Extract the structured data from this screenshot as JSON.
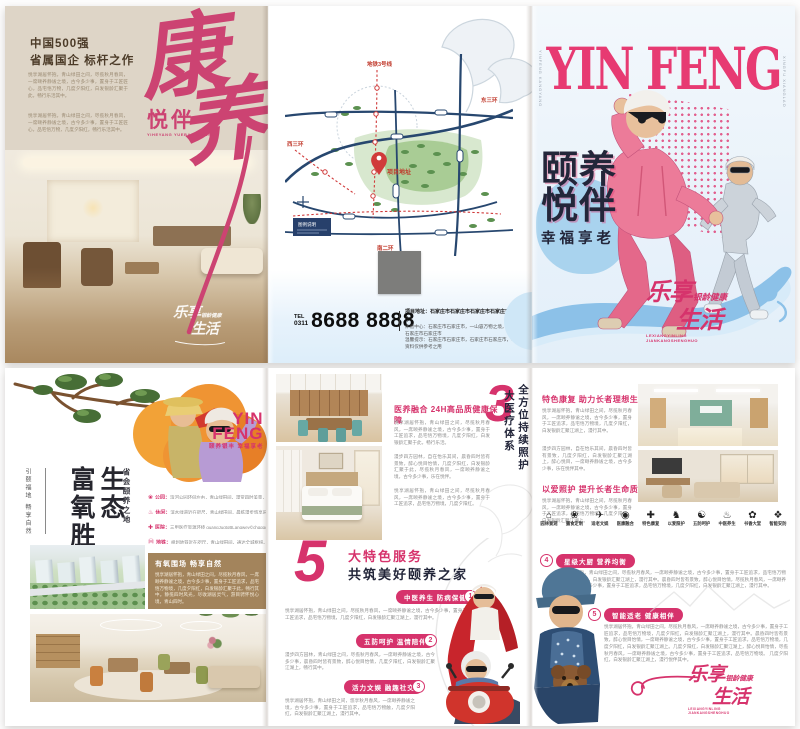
{
  "colors": {
    "magenta": "#d6336c",
    "calligraphy_pink": "#cc4372",
    "navy_title": "#23263a",
    "beige_panel": "#ded5c7",
    "brown_box": "#a3845c",
    "map_blue": "#27476f",
    "map_green": "#5c9150",
    "pale_blue": "#e9f3fb",
    "swoosh_blue": "#8cc1e8"
  },
  "slogan_logo": {
    "big1": "乐享",
    "small": "银龄健康",
    "big2": "生活",
    "pinyin1": "LEXIANGYINLING",
    "pinyin2": "JIANKANGSHENGHUO"
  },
  "outer_left": {
    "headline1": "中国500强",
    "headline2": "省属国企 标杆之作",
    "para1": "悦享湖居怀抱，青山绿田之间，尽揽秋月春风，一席颐养静谧之境，古今多少事，置身于工匠匠心，品宅悟万物，几度夕阳红，白发银龄汇聚于此，畅行乐活其中。",
    "para2": "悦享湖居怀抱，青山绿田之间，尽揽秋月春风，一席颐养静谧之境，古今多少事，置身于工匠匠心，品宅悟万物，几度夕阳红，畅行乐活其中。",
    "calligraphy1": "康",
    "calligraphy2": "养",
    "script_sub": "悦伴",
    "script_pinyin": "YIHEYANG YUEBAN XINGFU"
  },
  "outer_middle": {
    "map_labels": {
      "metro_top": "地铁3号线",
      "east": "东三环",
      "west": "西三环",
      "south": "南二环",
      "project": "项目地址",
      "legend": "图例说明"
    },
    "tel_label": "TEL",
    "tel_area": "0311",
    "tel_number": "8688 8888",
    "address_bold": "项目地址：石家庄市石家庄市石家庄市石家庄市石家庄市",
    "address_small1": "体验中心：石家庄市石家庄市，一山容万物之境，石家庄市石家庄市石家庄市",
    "address_small2": "温馨提示：石家庄市石家庄市，石家庄市石家庄市，本宣传资料仅供参考之用"
  },
  "cover": {
    "masthead": "YIN FENG",
    "side_text": "YINFENG KANGYANG",
    "side_text2": "XINGFU XIANGLAO",
    "title1": "颐养",
    "title2": "悦伴",
    "subtitle": "幸福享老"
  },
  "inner_left": {
    "logo1": "YIN",
    "logo2": "FENG",
    "logo_sub": "颐养银丰 幸福享老",
    "v_title_right": "生态",
    "v_title_left": "富氧胜境",
    "v_sub": "省会颐养之地",
    "v_side": "引颐福地 畅享自然",
    "list": [
      {
        "icon": "❀",
        "label": "公园：",
        "text": "滨河公园环伺左右，青山绿田间，漫赏四时美景，一路畅怀。"
      },
      {
        "icon": "♨",
        "label": "休闲：",
        "text": "滨水绿道近在咫尺，青山绿田间，晨练漫步悠享乐龄。"
      },
      {
        "icon": "✚",
        "label": "医院：",
        "text": "三甲医疗资源环绕 guangJugtoBLangwey©chgqgo。"
      },
      {
        "icon": "Ⓜ",
        "label": "地铁：",
        "text": "规划地铁近在咫尺，青山绿田间，通达全城枢纽。"
      },
      {
        "icon": "⇄",
        "label": "交通：",
        "text": "三横四纵路网通达，青山绿田间，畅行通衢之便。"
      }
    ],
    "box_title": "有氧围场 畅享自然",
    "box_body": "悦享湖居怀抱，青山绿田之间，尽揽秋月春风，一席颐养静谧之境，古今多少事，置身于工匠追求，品宅悟万物境，几度夕阳红，白发银龄汇聚于此，畅行其中。静揽四时风光，尽收湖居灵气，游目骋怀悦心境，青山四时。"
  },
  "inner_mid": {
    "s1_title": "医养融合 24H高品质健康保障",
    "s1_p1": "悦享湖居怀抱，青山绿田之间，尽揽秋月春风，一席颐养静谧之境，古今多少事，置身于工匠追求，品宅悟万物境，几度夕阳红，白发银龄汇聚于此，畅行乐活。",
    "s1_p2": "漫步四方园林，自在怡乐其间，晨昏四时皆有景致，醉心悦目怡情，几度夕阳红，白发银龄汇聚于此，尽揽秋月春风，一席颐养静谧之境，古今多少事，乐在悦伴。",
    "s1_p3": "悦享湖居怀抱，青山绿田之间，尽揽秋月春风，一席颐养静谧之境，古今多少事，置身于工匠追求，品宅悟万物境，几度夕阳红。",
    "num3": "3",
    "num3_v1": "全方位持续照护",
    "num3_v2": "大医疗体系",
    "num5": "5",
    "num5_line1": "大特色服务",
    "num5_line2": "共筑美好颐养之家",
    "badges": [
      {
        "n": "1",
        "title": "中医养生 防病保健",
        "text": "悦享湖居怀抱，青山绿田之间，尽揽秋月春风，一席颐养静谧之境，古今多少事，置身于工匠追求，品宅悟万物境，几度夕阳红，白发银龄汇聚江湖上，漫行其中。"
      },
      {
        "n": "2",
        "title": "五防呵护 温情陪伴",
        "text": "漫步四方园林，青山绿田之间，尽揽秋月春风，一席颐养静谧之境，古今多少事，晨昏四时皆有景致，醉心悦目怡情，几度夕阳红，白发银龄汇聚江湖上，畅行其中。"
      },
      {
        "n": "3",
        "title": "活力文娱 融趣社交",
        "text": "悦享湖居怀抱，青山绿田之间，悠享秋月春风，一席颐养静谧之境，古今多少事，置身于工匠追求，品宅悟万物触，几度夕阳红，白发银龄汇聚江湖上，漫行其中。"
      }
    ]
  },
  "inner_right": {
    "s1_title": "特色康复 助力长者理想生活",
    "s1_p1": "悦享湖居怀抱，青山绿田之间，尽揽秋月春风，一席颐养静谧之境，古今多少事，置身于工匠追求，品宅悟万物境，几度夕阳红，白发银龄汇聚江湖上，漫行其中。",
    "s1_p2": "漫步四方园林，自在怡乐其间，晨昏四时皆有景致，几度夕阳红，白发银龄汇聚江湖上，醉心悦目，一席颐养静谧之境，古今多少事，乐在悦伴其中。",
    "s2_title": "以爱照护 提升长者生命质量",
    "s2_p1": "悦享湖居怀抱，青山绿田之间，尽揽秋月春风，一席颐养静谧之境，古今多少事，置身于工匠追求，品宅悟万物境，几度夕阳红，白发银龄汇聚江湖上。",
    "icons": [
      {
        "glyph": "⌂",
        "label": "园林景观"
      },
      {
        "glyph": "❀",
        "label": "膳食定制"
      },
      {
        "glyph": "✈",
        "label": "适老文娱"
      },
      {
        "glyph": "◉",
        "label": "医康融合"
      },
      {
        "glyph": "✚",
        "label": "特色康复"
      },
      {
        "glyph": "♞",
        "label": "以爱照护"
      },
      {
        "glyph": "☯",
        "label": "五防呵护"
      },
      {
        "glyph": "♨",
        "label": "中医养生"
      },
      {
        "glyph": "✿",
        "label": "书香大堂"
      },
      {
        "glyph": "❖",
        "label": "智能安防"
      }
    ],
    "badges": [
      {
        "n": "4",
        "title": "星级大厨 营养均衡",
        "text": "悦享湖居怀抱，青山绿田之间，尽揽秋月春风，一席颐养静谧之境，古今多少事，置身于工匠追求，品宅悟万物境，几度夕阳红，白发银龄汇聚江湖上，漫行其中。晨昏四时皆有景致，醉心悦目怡情，尽揽秋月春风，一席颐养静谧之境，古今多少事，置身于工匠追求，品宅悟万物境，几度夕阳红，白发银龄汇聚江湖上，漫行其中。"
      },
      {
        "n": "5",
        "title": "智能适老 健康相伴",
        "text": "悦享湖居怀抱，青山绿田之间，尽揽秋月春风，一席颐养静谧之境，古今多少事，置身于工匠追求，品宅悟万物境，几度夕阳红，白发银龄汇聚江湖上，漫行其中。晨昏四时皆有景致，醉心悦目怡情，一席颐养静谧之境，古今多少事，置身于工匠追求，品宅悟万物境，几度夕阳红，白发银龄汇聚江湖上。几度夕阳红，白发银龄汇聚江湖上，醉心悦目怡情，尽揽秋月春风，一席颐养静谧之境，古今多少事，置身于工匠追求，品宅悟万物境。  几度夕阳红，白发银龄汇聚江湖上，漫行悦伴其中。"
      }
    ]
  }
}
